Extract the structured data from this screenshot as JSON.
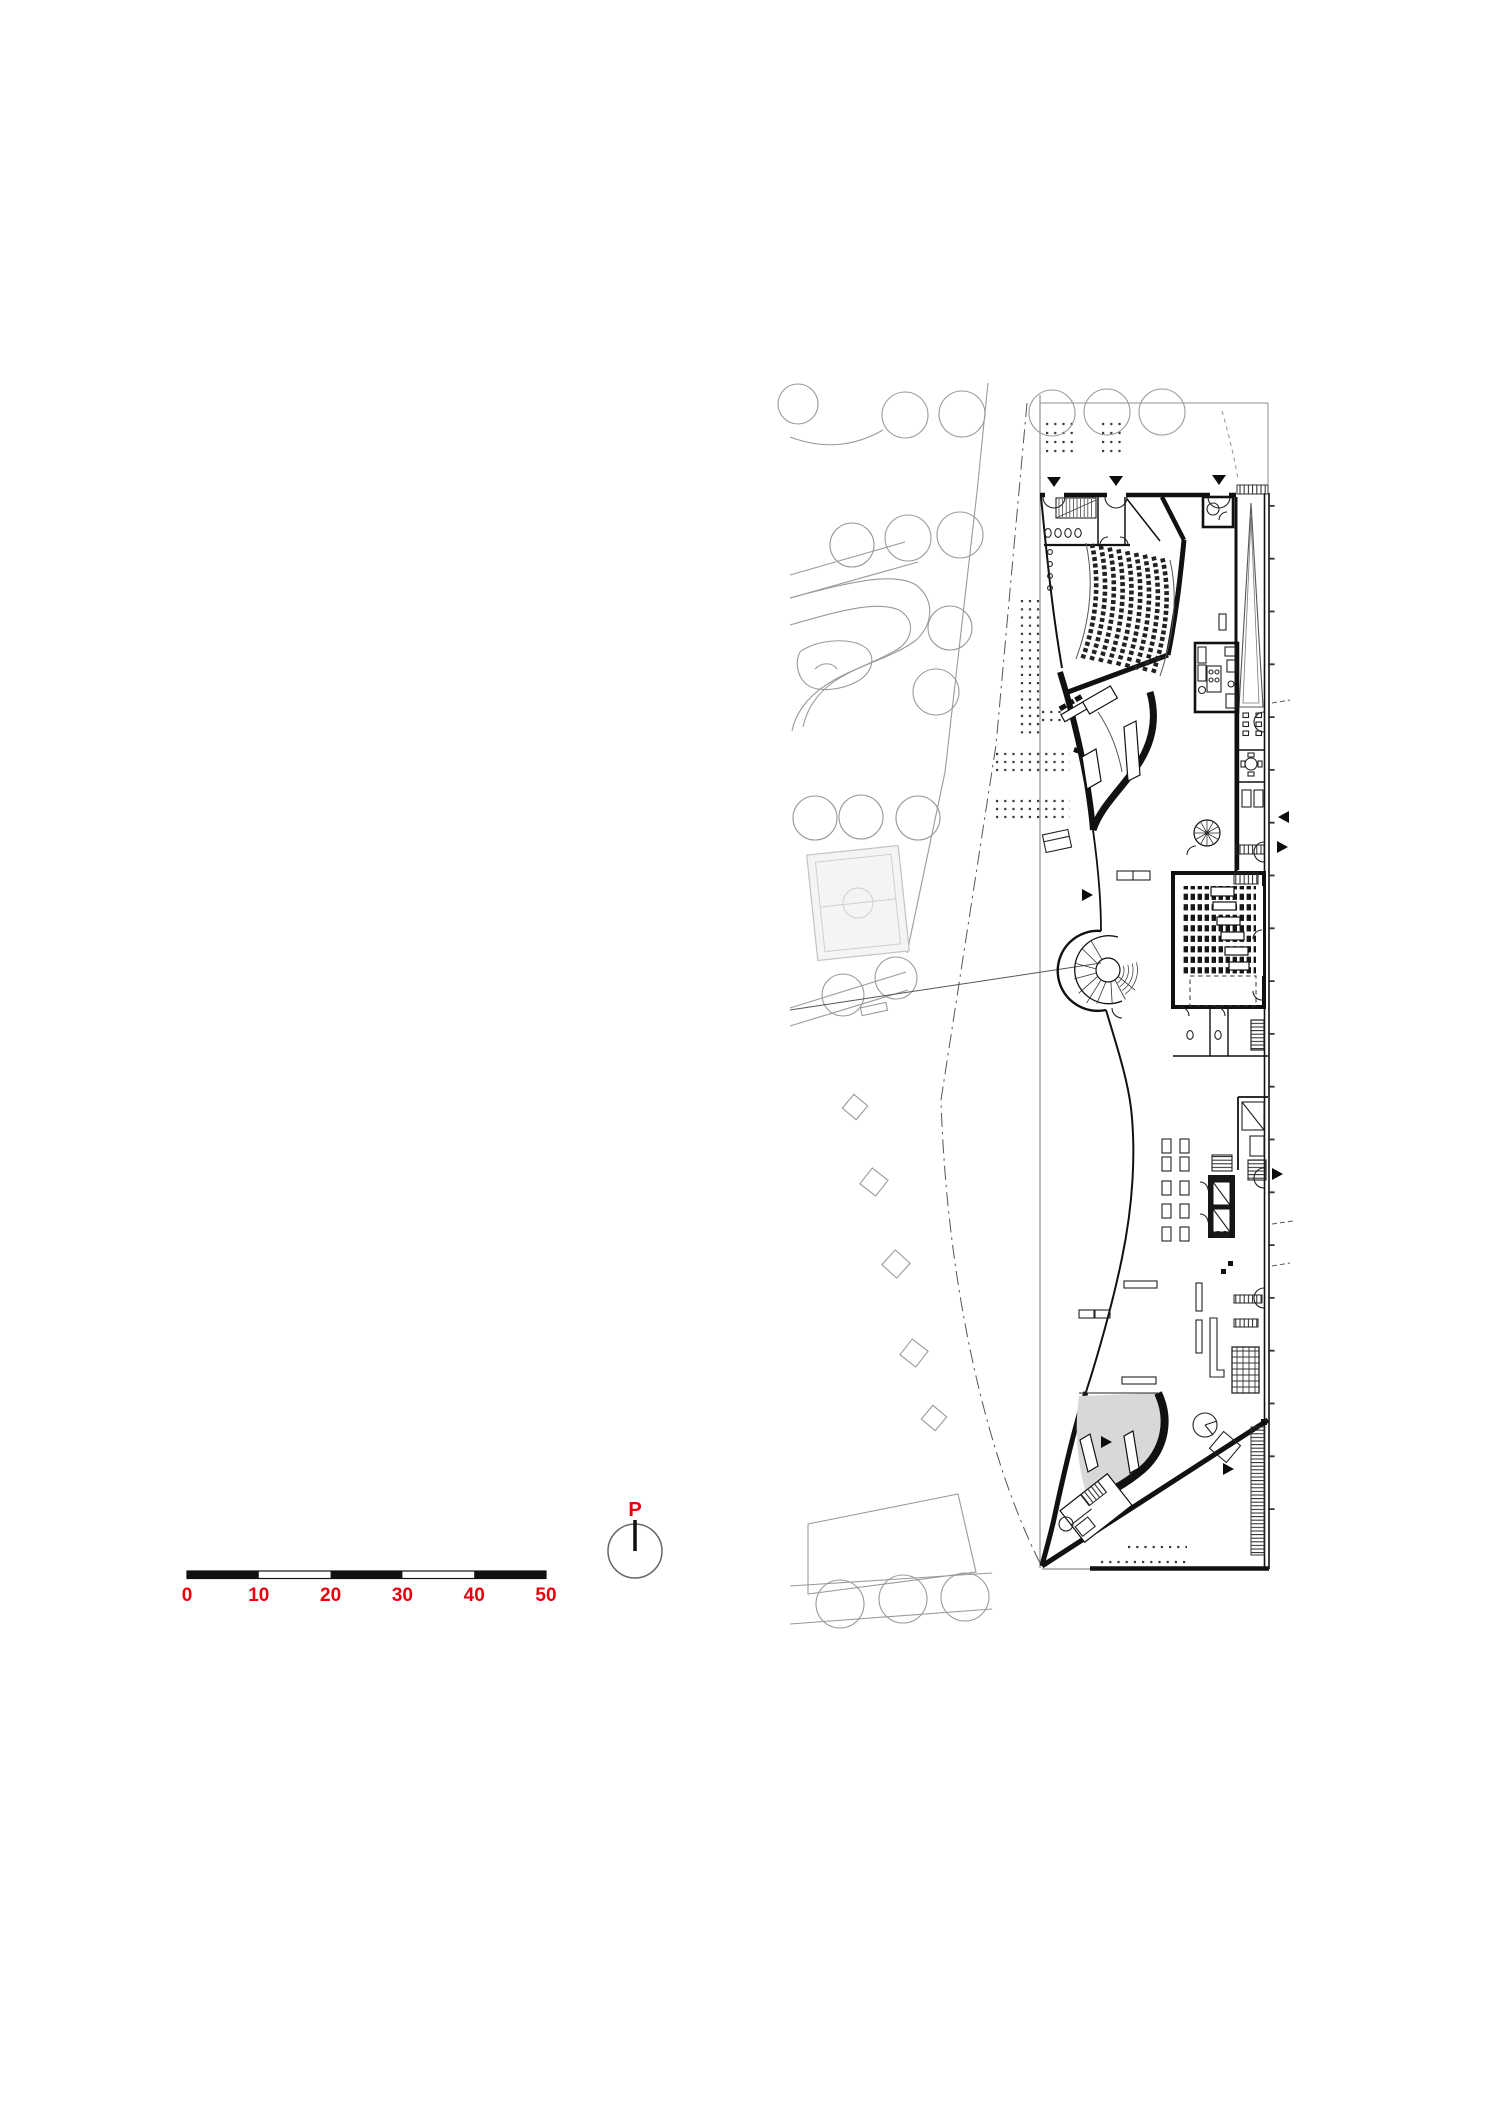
{
  "document": {
    "type": "architectural-site-plan-ground-floor",
    "background": "#ffffff"
  },
  "scale_bar": {
    "labels": [
      "0",
      "10",
      "20",
      "30",
      "40",
      "50"
    ],
    "total_meters": 50,
    "segment_meters": 10,
    "color": "#e8000d"
  },
  "north_symbol": {
    "label": "P",
    "color": "#e8000d"
  },
  "colors": {
    "ink": "#111111",
    "site_gray": "#8f8f8f",
    "park_gray": "#9a9a9a",
    "area_fill_gray": "#d8d8d8",
    "field_fill": "#f4f4f4",
    "red": "#e8000d"
  }
}
